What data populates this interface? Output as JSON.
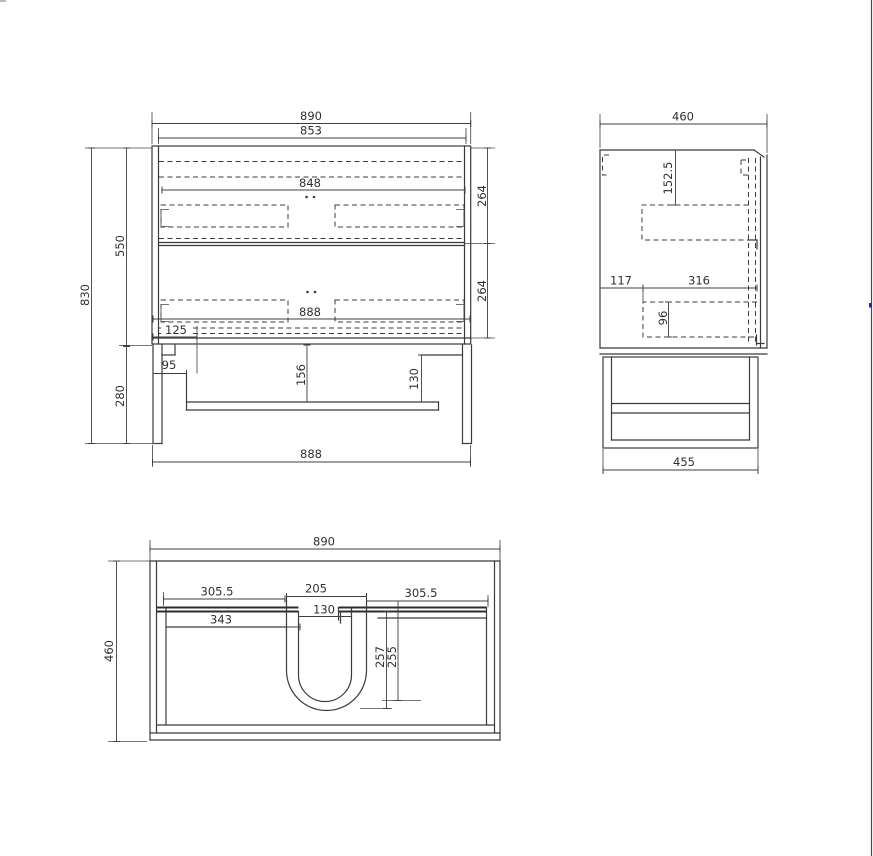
{
  "front_view": {
    "overall_width": "890",
    "carcass_width": "853",
    "top_inner_width": "848",
    "drawer_width": "888",
    "bottom_inset": "125",
    "upper_drawer_height": "264",
    "lower_drawer_height": "264",
    "carcass_height": "550",
    "overall_height": "830",
    "leg_frame_height": "280",
    "leg_offset": "95",
    "rail_drop": "156",
    "bracket_height": "130",
    "base_width": "888"
  },
  "side_view": {
    "overall_depth": "460",
    "top_offset": "152.5",
    "back_offset": "117",
    "drawer_depth": "316",
    "drawer_box_height": "96",
    "base_depth": "455"
  },
  "plan_view": {
    "overall_width": "890",
    "overall_depth": "460",
    "left_offset": "305.5",
    "cutout_width": "205",
    "right_offset": "305.5",
    "cutout_inner_width": "130",
    "left_inner_offset": "343",
    "cutout_depth_outer": "257",
    "cutout_depth_inner": "255"
  }
}
